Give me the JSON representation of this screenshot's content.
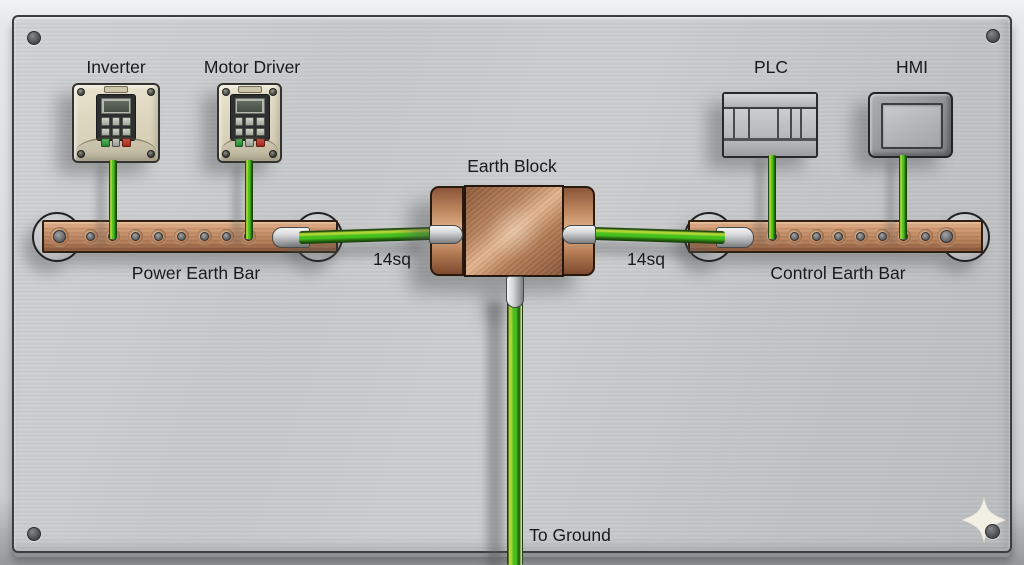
{
  "labels": {
    "inverter": "Inverter",
    "motor_driver": "Motor Driver",
    "plc": "PLC",
    "hmi": "HMI",
    "earth_block": "Earth Block",
    "power_earth_bar": "Power Earth Bar",
    "control_earth_bar": "Control Earth Bar",
    "left_wire_size": "14sq",
    "right_wire_size": "14sq",
    "to_ground": "To Ground"
  },
  "icons": {
    "logo": "sparkle-four-point-star-icon",
    "corner_fasteners": "panel-screw-icon"
  },
  "colors": {
    "panel_gray": "#c8cacc",
    "copper_base": "#c48c66",
    "copper_light": "#e4b68e",
    "copper_dark": "#8a5638",
    "wire_green": "#46c01d",
    "wire_green_highlight": "#aed636",
    "wire_green_dark": "#276f10",
    "device_beige": "#ddd6bf",
    "plc_gray": "#b3b6b8",
    "hmi_gray": "#94979a",
    "ferrule_silver": "#c2c4c6",
    "text": "#1a1a1a"
  }
}
